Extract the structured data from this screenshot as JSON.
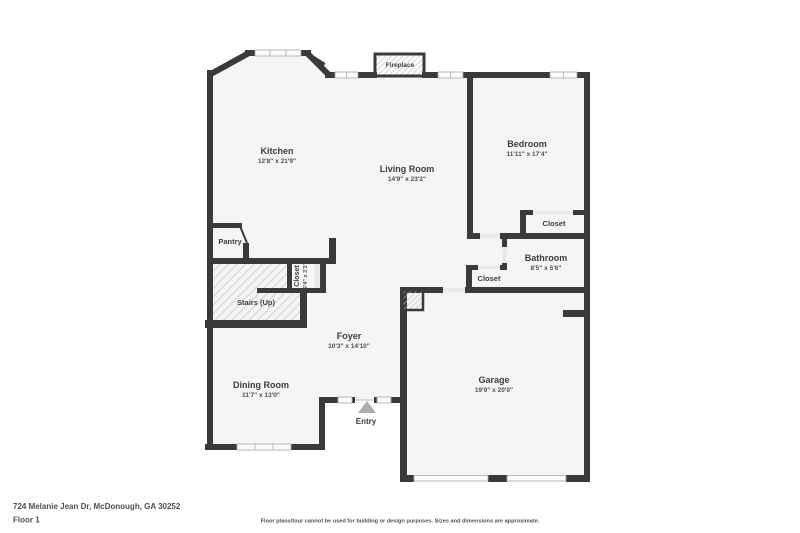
{
  "colors": {
    "wall": "#3a3a3c",
    "floor": "#f5f5f6",
    "background": "#ffffff",
    "door_opening": "#e9e9e9",
    "entry_arrow": "#adadad",
    "hatch_line": "#cdcdcd"
  },
  "plan": {
    "rooms": {
      "kitchen": {
        "name": "Kitchen",
        "dims": "12'8\" x 21'9\""
      },
      "living_room": {
        "name": "Living Room",
        "dims": "14'9\" x 23'2\""
      },
      "bedroom": {
        "name": "Bedroom",
        "dims": "11'11\" x 17'4\""
      },
      "bedroom_closet": {
        "name": "Closet"
      },
      "bathroom": {
        "name": "Bathroom",
        "dims": "8'5\" x 5'6\""
      },
      "hall_closet": {
        "name": "Closet"
      },
      "stairs_closet": {
        "name": "Closet",
        "dims": "2'4\" x 3'3\""
      },
      "stairs": {
        "name": "Stairs (Up)"
      },
      "pantry": {
        "name": "Pantry"
      },
      "foyer": {
        "name": "Foyer",
        "dims": "10'3\" x 14'10\""
      },
      "dining_room": {
        "name": "Dining Room",
        "dims": "11'7\" x 13'0\""
      },
      "garage": {
        "name": "Garage",
        "dims": "19'9\" x 20'0\""
      },
      "entry": {
        "name": "Entry"
      },
      "fireplace": {
        "name": "Fireplace"
      }
    }
  },
  "footer": {
    "address": "724 Melanie Jean Dr, McDonough, GA 30252",
    "floor_label": "Floor 1",
    "disclaimer": "Floor plans/tour cannot be used for building or design purposes. Sizes and dimensions are approximate."
  }
}
